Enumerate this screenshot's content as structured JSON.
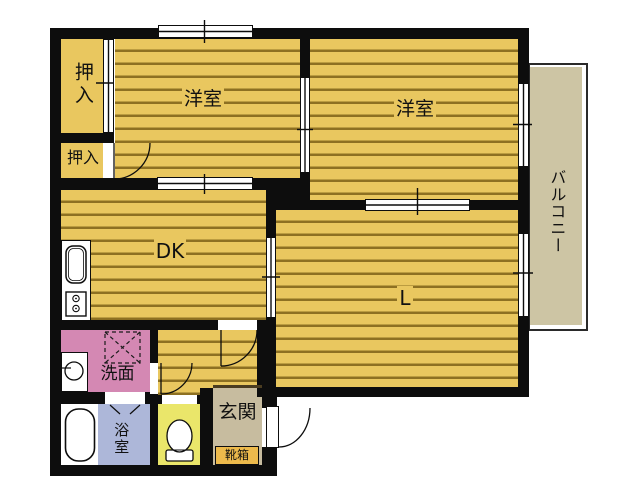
{
  "rooms": {
    "closet_top": {
      "label": "押入"
    },
    "closet_bottom": {
      "label": "押入"
    },
    "bedroom_left": {
      "label": "洋室"
    },
    "bedroom_right": {
      "label": "洋室"
    },
    "dining_kitchen": {
      "label": "DK"
    },
    "living": {
      "label": "L"
    },
    "washroom": {
      "label": "洗面"
    },
    "bathroom": {
      "label": "浴室"
    },
    "entrance": {
      "label": "玄関"
    },
    "shoe_cabinet": {
      "label": "靴箱"
    },
    "balcony": {
      "label": "バルコニー"
    }
  },
  "colors": {
    "wall": "#0d0d0d",
    "floor_yellow": "#e9c75f",
    "floor_stripe": "#8d7022",
    "washroom_pink": "#d488b3",
    "bathroom_blue": "#adb7d9",
    "toilet_yellow": "#eae66a",
    "entrance_tan": "#c7bc9f",
    "shoebox_orange": "#edba4c",
    "balcony_beige": "#cdc5a4"
  },
  "icons": {
    "kitchen_sink": "rounded-rect-basin",
    "stove": "box-with-two-burners",
    "washing_machine_pan": "dashed-square-with-x",
    "washbasin": "circle-with-tap",
    "bathtub": "rounded-rect-tub",
    "toilet": "bowl-and-tank",
    "door": "quarter-arc-swing",
    "window": "white-double-line"
  }
}
